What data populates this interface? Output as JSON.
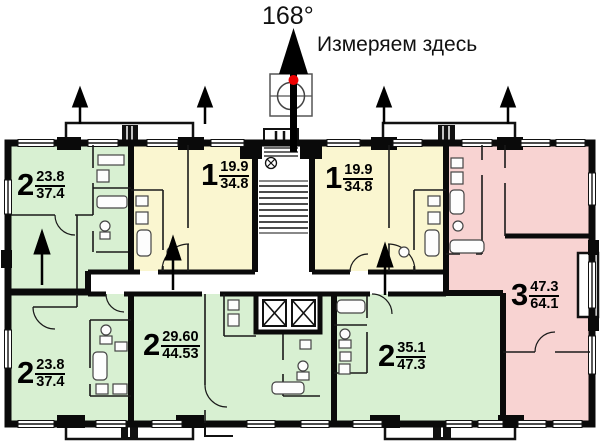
{
  "header": {
    "bearing": "168°",
    "note": "Измеряем здесь"
  },
  "apartments": [
    {
      "id": "apt-2-top-left",
      "rooms": "2",
      "living_area": "23.8",
      "total_area": "37.4",
      "color_name": "green"
    },
    {
      "id": "apt-1-left-of-stairs",
      "rooms": "1",
      "living_area": "19.9",
      "total_area": "34.8",
      "color_name": "yellow"
    },
    {
      "id": "apt-1-right-of-stairs",
      "rooms": "1",
      "living_area": "19.9",
      "total_area": "34.8",
      "color_name": "yellow"
    },
    {
      "id": "apt-3-right",
      "rooms": "3",
      "living_area": "47.3",
      "total_area": "64.1",
      "color_name": "pink"
    },
    {
      "id": "apt-2-bottom-left",
      "rooms": "2",
      "living_area": "23.8",
      "total_area": "37.4",
      "color_name": "green"
    },
    {
      "id": "apt-2-bottom-middle",
      "rooms": "2",
      "living_area": "29.60",
      "total_area": "44.53",
      "color_name": "green"
    },
    {
      "id": "apt-2-bottom-right",
      "rooms": "2",
      "living_area": "35.1",
      "total_area": "47.3",
      "color_name": "green"
    }
  ],
  "colors": {
    "green": "#d8f0d2",
    "yellow": "#faf6d0",
    "pink": "#f8d3d2",
    "wall": "#0a0a0a",
    "marker_red": "#ee0000",
    "background": "#ffffff"
  }
}
